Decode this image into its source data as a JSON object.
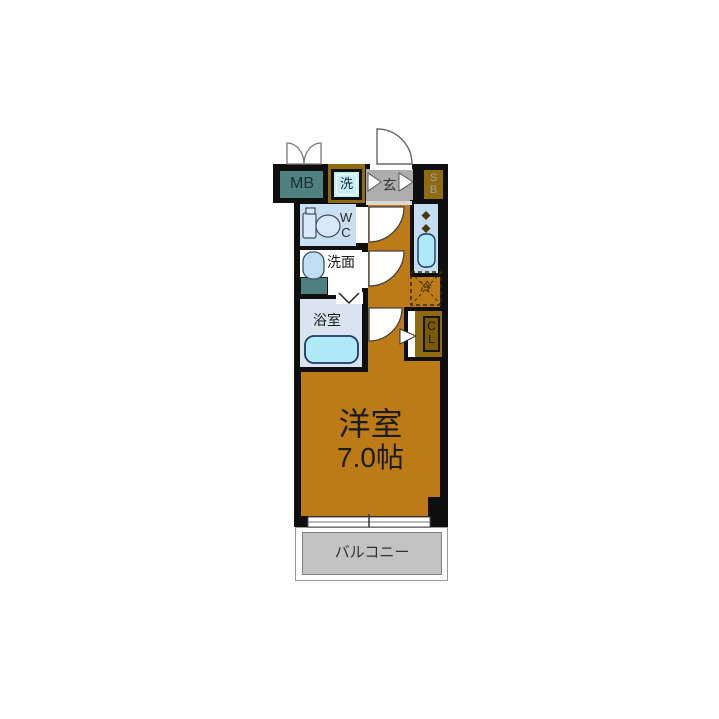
{
  "plan": {
    "type": "apartment-floor-plan",
    "rooms": {
      "meter_box": {
        "label": "MB"
      },
      "washer": {
        "label": "洗"
      },
      "entrance": {
        "label": "玄"
      },
      "shoe_box": {
        "label": "SB"
      },
      "toilet": {
        "label": "WC"
      },
      "washroom": {
        "label": "洗面"
      },
      "bathroom": {
        "label": "浴室"
      },
      "refrigerator": {
        "label": "冷"
      },
      "closet": {
        "label": "CL"
      },
      "main_room": {
        "label": "洋室",
        "size": "7.0帖"
      },
      "balcony": {
        "label": "バルコニー"
      }
    }
  },
  "colors": {
    "wall": "#0f0f0f",
    "room": "#bc7b16",
    "mb": "#508181",
    "entry_gray": "#adadad",
    "brown": "#8f6b0e",
    "brown_dark": "#7a5a05",
    "wash_cyan": "#c6eff3",
    "wc_bg": "#cbdff2",
    "bath_bg": "#d9e4f0",
    "kitchen_bg": "#c5ddf1",
    "fixture_blue": "#b0eaf8",
    "fixture_light": "#d9e9f9",
    "sink_blue": "#bfe0f4",
    "teal_counter": "#4f8080",
    "balcony_floor": "#c3c3c3",
    "label_dark": "#222222",
    "sb_letter": "#97a3ad"
  }
}
